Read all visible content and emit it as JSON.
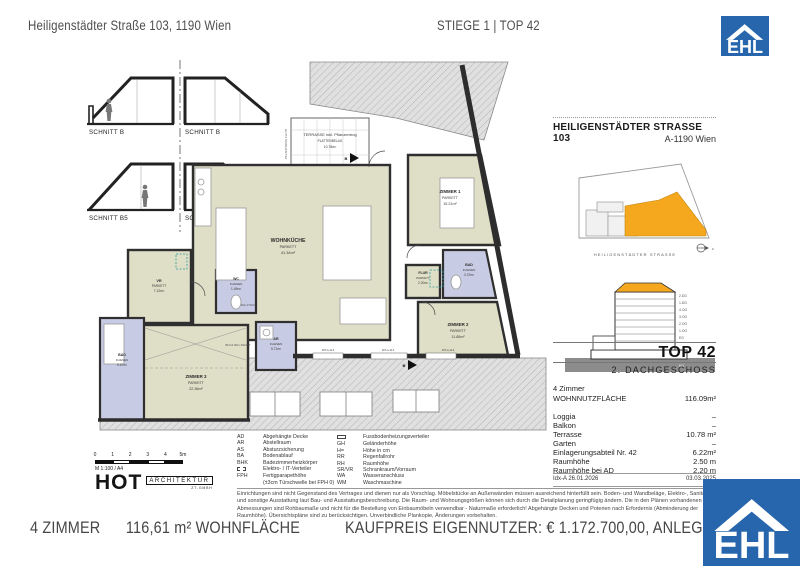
{
  "header": {
    "address": "Heiligenstädter Straße 103, 1190 Wien",
    "unit": "STIEGE 1 | TOP 42"
  },
  "logo": {
    "text": "EHL"
  },
  "sections": {
    "labels": [
      "SCHNITT B",
      "SCHNITT B",
      "SCHNITT B5",
      "SCHNITT B2"
    ]
  },
  "floorplan": {
    "terrace": {
      "name": "TERRASSE inkl. Pflanzentrog",
      "floor": "PLATTENBELAG",
      "area": "10.78m²"
    },
    "rooms": [
      {
        "name": "WOHNKÜCHE",
        "floor": "PARKETT",
        "area": "41.34m²"
      },
      {
        "name": "ZIMMER 1",
        "floor": "PARKETT",
        "area": "15.21m²"
      },
      {
        "name": "ZIMMER 2",
        "floor": "PARKETT",
        "area": "11.85m²"
      },
      {
        "name": "ZIMMER 3",
        "floor": "PARKETT",
        "area": "22.36m²"
      },
      {
        "name": "VR",
        "floor": "PARKETT",
        "area": "7.12m²"
      },
      {
        "name": "FLUR",
        "floor": "PARKETT",
        "area": "2.20m²"
      },
      {
        "name": "WC",
        "floor": "FLIESEN",
        "area": "1.49m²"
      },
      {
        "name": "BAD",
        "floor": "FLIESEN",
        "area": "3.37m²"
      },
      {
        "name": "BAD",
        "floor": "FLIESEN",
        "area": "5.67m²"
      },
      {
        "name": "AR",
        "floor": "FLIESEN",
        "area": "5.71m²"
      }
    ],
    "annotations": {
      "fph": "FPH+114",
      "rh": "RH=2.50m",
      "bh": "BH=2.00m FENST",
      "pflanz": "PFLANZTROG FH=78",
      "marker": "B"
    }
  },
  "sidebar": {
    "title": "HEILIGENSTÄDTER STRASSE 103",
    "subtitle": "A-1190 Wien",
    "street_label": "HEILIGENSTÄDTER STRASSE",
    "north_label": "z",
    "elevation_floors": [
      "2.DG",
      "1.DG",
      "4.OG",
      "3.OG",
      "2.OG",
      "1.OG",
      "EG",
      "KG"
    ],
    "top": "TOP 42",
    "level": "2. DACHGESCHOSS",
    "rooms_count": "4 Zimmer",
    "details": [
      {
        "label": "WOHNNUTZFLÄCHE",
        "value": "116.09m²"
      },
      {
        "label": "Loggia",
        "value": "–"
      },
      {
        "label": "Balkon",
        "value": "–"
      },
      {
        "label": "Terrasse",
        "value": "10.78 m²"
      },
      {
        "label": "Garten",
        "value": "–"
      },
      {
        "label": "Einlagerungsabteil Nr. 42",
        "value": "6.22m²"
      },
      {
        "label": "Raumhöhe",
        "value": "2.50 m"
      },
      {
        "label": "Raumhöhe bei AD",
        "value": "2.20 m"
      }
    ],
    "idx": "Idx-A 26.01.2026",
    "date": "03.03.2025"
  },
  "legend": {
    "left": [
      {
        "abbr": "AD",
        "text": "Abgehängte Decke"
      },
      {
        "abbr": "AR",
        "text": "Abstellraum"
      },
      {
        "abbr": "AS",
        "text": "Absturzsicherung"
      },
      {
        "abbr": "BA",
        "text": "Bodenablauf"
      },
      {
        "abbr": "BHK",
        "text": "Badezimmerheizkörper"
      },
      {
        "abbr": "",
        "icon": "elektro-verteiler-symbol",
        "text": "Elektro- / IT-Verteiler"
      },
      {
        "abbr": "FPH",
        "text": "Fertigparapethöhe"
      },
      {
        "abbr": "",
        "text": "(±3cm Türschwelle bei FPH 0)"
      }
    ],
    "right": [
      {
        "abbr": "",
        "icon": "fussbodenheizung-symbol",
        "text": "Fussbodenheizungsverteiler"
      },
      {
        "abbr": "GH",
        "text": "Geländerhöhe"
      },
      {
        "abbr": "H=",
        "text": "Höhe in cm"
      },
      {
        "abbr": "RR",
        "text": "Regenfallrohr"
      },
      {
        "abbr": "RH",
        "text": "Raumhöhe"
      },
      {
        "abbr": "SR/VR",
        "text": "Schrankraum/Vorraum"
      },
      {
        "abbr": "WA",
        "text": "Wasseranschluss"
      },
      {
        "abbr": "WM",
        "text": "Waschmaschine"
      }
    ]
  },
  "scalebar": {
    "ticks": [
      "0",
      "1",
      "2",
      "3",
      "4",
      "5m"
    ],
    "scale": "M 1:100 / A4"
  },
  "architect": {
    "name": "HOT",
    "type": "ARCHITEKTUR",
    "sub": "ZT-GMBH"
  },
  "disclaimer": "Einrichtungen sind nicht Gegenstand des Vertrages und dienen nur als Vorschlag. Möbelstücke an Außenwänden müssen ausreichend hinterfüllt sein. Boden- und Wandbeläge, Elektro-, Sanitär und sonstige Ausstattung laut Bau- und Ausstattungsbeschreibung. Die Raum- und Wohnungsgrößen können sich durch die Detailplanung geringfügig ändern. Die in den Plänen vorhandenen Abmessungen sind Rohbaumaße und nicht für die Bestellung von Einbaumöbeln verwendbar - Naturmaße erforderlich! Abgehängte Decken und Poterien nach Erfordernis (Abminderung der Raumhöhe). Übersichtspläne sind zu berücksichtigen. Unverbindliche Plankopie, Änderungen vorbehalten.",
  "footer": {
    "rooms": "4 ZIMMER",
    "area": "116,61 m² WOHNFLÄCHE",
    "price": "KAUFPREIS EIGENNUTZER: € 1.172.700,00, ANLEGER: € 1.08"
  },
  "colors": {
    "accent_blue": "#2766AC",
    "room_beige": "#DFDEC6",
    "wet_blue": "#C7CBE3",
    "highlight_orange": "#F5A81E"
  }
}
